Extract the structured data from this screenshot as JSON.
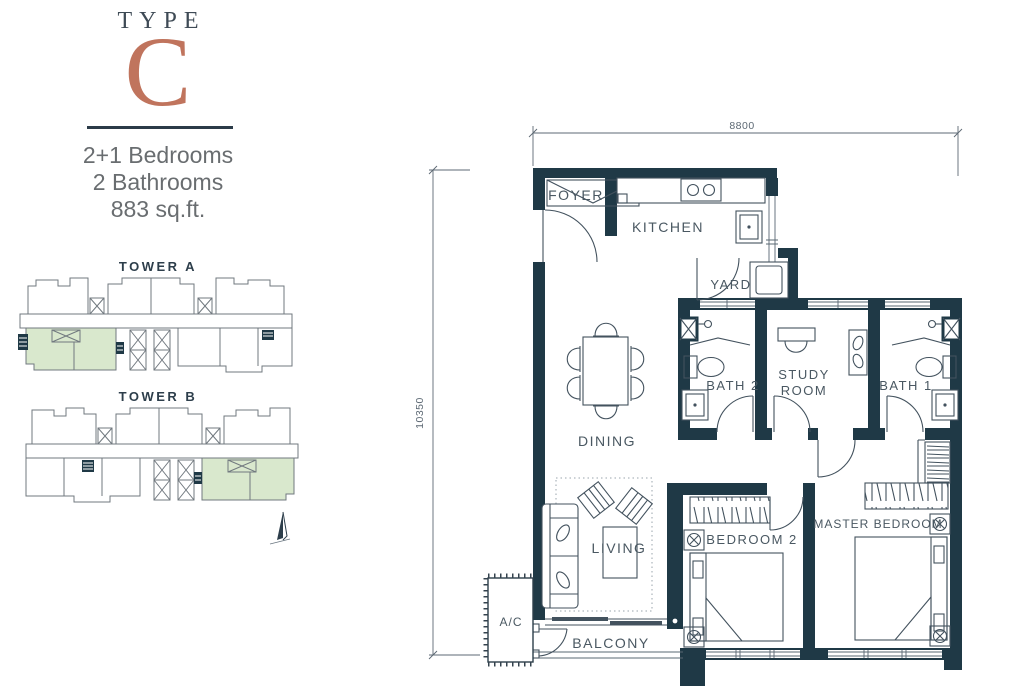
{
  "colors": {
    "wall": "#1f3946",
    "accent_letter": "#c0745d",
    "unit_highlight_green": "#d9e8cd",
    "label_text": "#4a5862",
    "spec_text": "#696d70"
  },
  "title": {
    "type_label": "TYPE",
    "type_letter": "C"
  },
  "specs": {
    "bedrooms": "2+1 Bedrooms",
    "bathrooms": "2 Bathrooms",
    "area": "883 sq.ft."
  },
  "keyplans": {
    "tower_a_label": "TOWER A",
    "tower_b_label": "TOWER B"
  },
  "floorplan": {
    "dim_width": "8800",
    "dim_height": "10350",
    "rooms": {
      "foyer": "FOYER",
      "kitchen": "KITCHEN",
      "yard": "YARD",
      "bath2": "BATH 2",
      "study_line1": "STUDY",
      "study_line2": "ROOM",
      "bath1": "BATH 1",
      "dining": "DINING",
      "living": "LIVING",
      "balcony": "BALCONY",
      "bedroom2": "BEDROOM 2",
      "master": "MASTER BEDROOM",
      "ac": "A/C"
    }
  }
}
